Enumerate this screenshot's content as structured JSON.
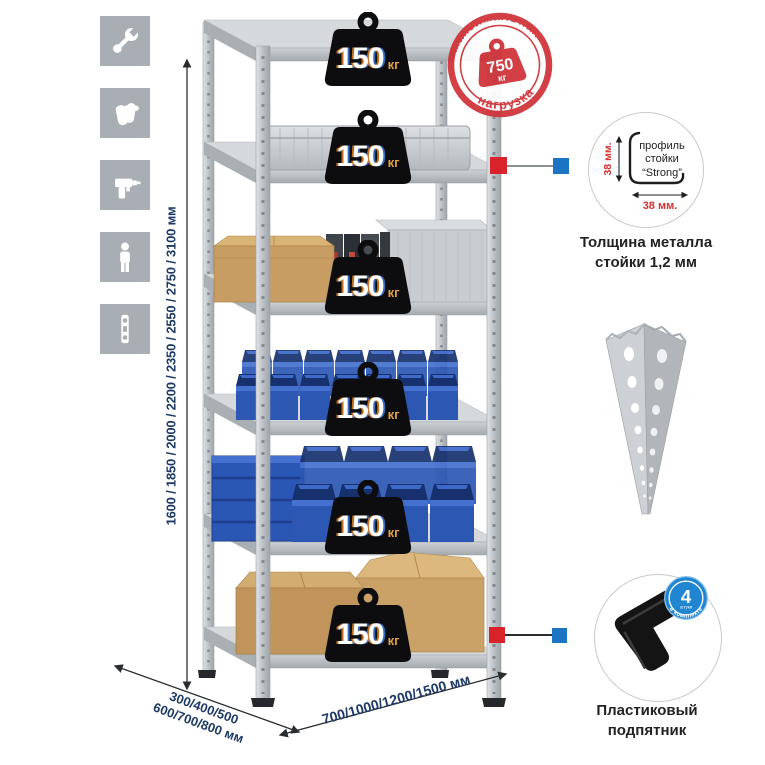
{
  "icons_panel": {
    "items": [
      {
        "icon": "wrench-icon"
      },
      {
        "icon": "gloves-icon"
      },
      {
        "icon": "drill-icon"
      },
      {
        "icon": "person-icon"
      },
      {
        "icon": "level-icon"
      }
    ]
  },
  "rack": {
    "badges": [
      {
        "value": "150",
        "unit": "кг"
      },
      {
        "value": "150",
        "unit": "кг"
      },
      {
        "value": "150",
        "unit": "кг"
      },
      {
        "value": "150",
        "unit": "кг"
      },
      {
        "value": "150",
        "unit": "кг"
      },
      {
        "value": "150",
        "unit": "кг"
      }
    ]
  },
  "stamp": {
    "arc_top": "максимальная",
    "arc_bottom": "нагрузка",
    "value": "750",
    "unit": "кг"
  },
  "dimensions": {
    "height_label": "1600 / 1850 / 2000 / 2200 / 2350 / 2550 / 2750 / 3100 мм",
    "depth_label_line1": "300/400/500",
    "depth_label_line2": "600/700/800 мм",
    "width_label": "700/1000/1200/1500 мм"
  },
  "profile_callout": {
    "text_line1": "профиль",
    "text_line2": "стойки",
    "text_line3": "“Strong”",
    "dim_vertical": "38 мм.",
    "dim_horizontal": "38 мм.",
    "caption_line1": "Толщина металла",
    "caption_line2": "стойки 1,2 мм"
  },
  "foot_callout": {
    "badge_number": "4",
    "badge_sub": "штуки",
    "badge_arc": "в комплекте",
    "caption_line1": "Пластиковый",
    "caption_line2": "подпятник"
  },
  "colors": {
    "stamp_red": "#cf3238",
    "connector_red": "#d8232a",
    "connector_blue": "#1b74c4",
    "dimension_text": "#1d3a66",
    "bin_blue": "#2c57b2",
    "metal_grey": "#c6c9cd",
    "cardboard": "#c79d63",
    "badge_black": "#0d0d0f"
  }
}
